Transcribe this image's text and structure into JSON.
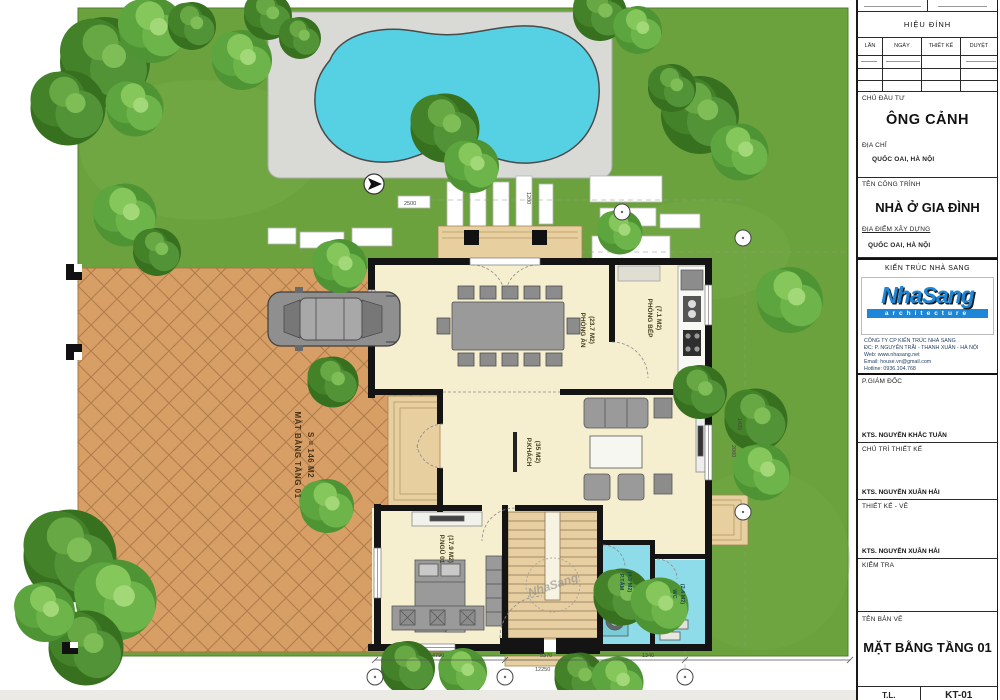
{
  "colors": {
    "grass": "#6CA23E",
    "pool": "#56D1E3",
    "deck": "#D9D9D6",
    "driveway": "#D79E66",
    "floor": "#F5EFD0",
    "bath": "#8EDCE9",
    "wood": "#E8CFA0",
    "wall": "#141414",
    "logo_blue": "#1E86D6"
  },
  "plan": {
    "rooms": {
      "dining": {
        "name": "PHÒNG ĂN",
        "area": "(23.7 M2)"
      },
      "kitchen": {
        "name": "PHÒNG BẾP",
        "area": "(7.1 M2)"
      },
      "living": {
        "name": "P.KHÁCH",
        "area": "(35 M2)"
      },
      "bedroom": {
        "name": "P.NGỦ 01",
        "area": "(17.9 M2)"
      },
      "bath1": {
        "name": "P.TẮM",
        "area": "(4.5 M2)"
      },
      "bath2": {
        "name": "WC",
        "area": "(2.4 M2)"
      }
    },
    "drive_label": {
      "line1": "MẶT BẰNG TẦNG 01",
      "line2": "S = 146 M2"
    },
    "watermark": "NhaSang",
    "dims": {
      "bottom": [
        "4790",
        "5370",
        "1340"
      ],
      "total": "12250",
      "right": [
        "1435",
        "2060"
      ],
      "pads": [
        "2500",
        "1200"
      ]
    }
  },
  "titleblock": {
    "revision": {
      "title": "HIỆU ĐÍNH",
      "cols": [
        "LẦN",
        "NGÀY",
        "THIẾT KẾ",
        "DUYỆT"
      ]
    },
    "investor": {
      "label": "CHỦ ĐẦU TƯ",
      "value": "ÔNG CẢNH",
      "address_label": "ĐỊA CHỈ",
      "address": "QUỐC OAI, HÀ NỘI"
    },
    "project": {
      "label": "TÊN CÔNG TRÌNH",
      "value": "NHÀ Ở GIA ĐÌNH",
      "site_label": "ĐỊA ĐIỂM XÂY DỰNG",
      "site": "QUỐC OAI, HÀ NỘI"
    },
    "firm": {
      "header": "KIẾN TRÚC NHÀ SANG",
      "logo_main": "NhaSang",
      "logo_sub": "architecture",
      "company": "CÔNG TY CP KIẾN TRÚC NHÀ SANG",
      "addr": "ĐC: P. NGUYỄN TRÃI - THANH XUÂN - HÀ NỘI",
      "web": "Web: www.nhasang.net",
      "email": "Email: house.vn@gmail.com",
      "hotline": "Hotline: 0936.104.768"
    },
    "signatures": [
      {
        "role": "P.GIÁM ĐỐC",
        "name": "KTS. NGUYỄN KHẮC TUẤN"
      },
      {
        "role": "CHỦ TRÌ THIẾT KẾ",
        "name": "KTS. NGUYỄN XUÂN HẢI"
      },
      {
        "role": "THIẾT KẾ - VẼ",
        "name": "KTS. NGUYỄN XUÂN HẢI"
      },
      {
        "role": "KIỂM TRA",
        "name": ""
      }
    ],
    "drawing": {
      "label": "TÊN BẢN VẼ",
      "value": "MẶT BẰNG TẦNG 01",
      "scale_label": "T.L.",
      "number": "KT-01"
    }
  }
}
